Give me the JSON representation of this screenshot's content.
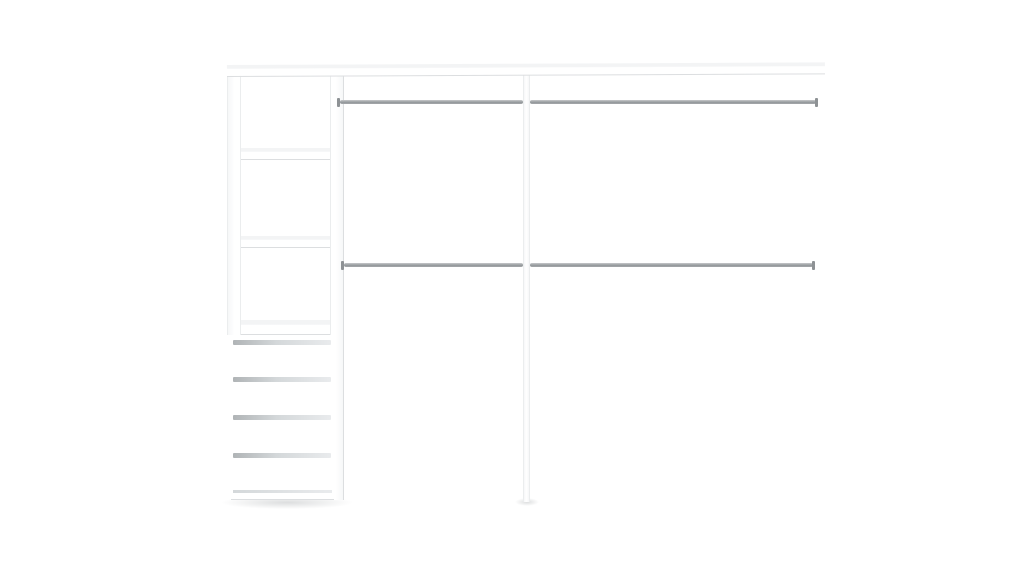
{
  "scene": {
    "type": "product-render",
    "description": "White wardrobe closet organizer with an open shelving tower, four drawers, a center divider panel and two double chrome hanging rods on a plain white background",
    "background_color": "#ffffff"
  },
  "structure": {
    "shelf_count": 3,
    "open_compartment_count": 3,
    "drawer_count": 4,
    "hanging_rod_count": 2,
    "rod_segments_per_rod": 2,
    "divider_panel_count": 1
  },
  "colors": {
    "background": "#ffffff",
    "panel_face": "#ffffff",
    "panel_top_face": "#f3f4f5",
    "panel_shade": "#f6f7f8",
    "panel_edge": "#dcdee0",
    "panel_edge_light": "#ebedee",
    "rod_light": "#c7c9cb",
    "rod_dark": "#92979a",
    "rod_mid": "#a6a9ab",
    "rod_cap": "#8e9295",
    "groove_start": "#b0b4b6",
    "groove_mid": "#d4d8da",
    "groove_end": "#e9ebed",
    "floor_shadow": "rgba(130,135,138,0.28)"
  }
}
